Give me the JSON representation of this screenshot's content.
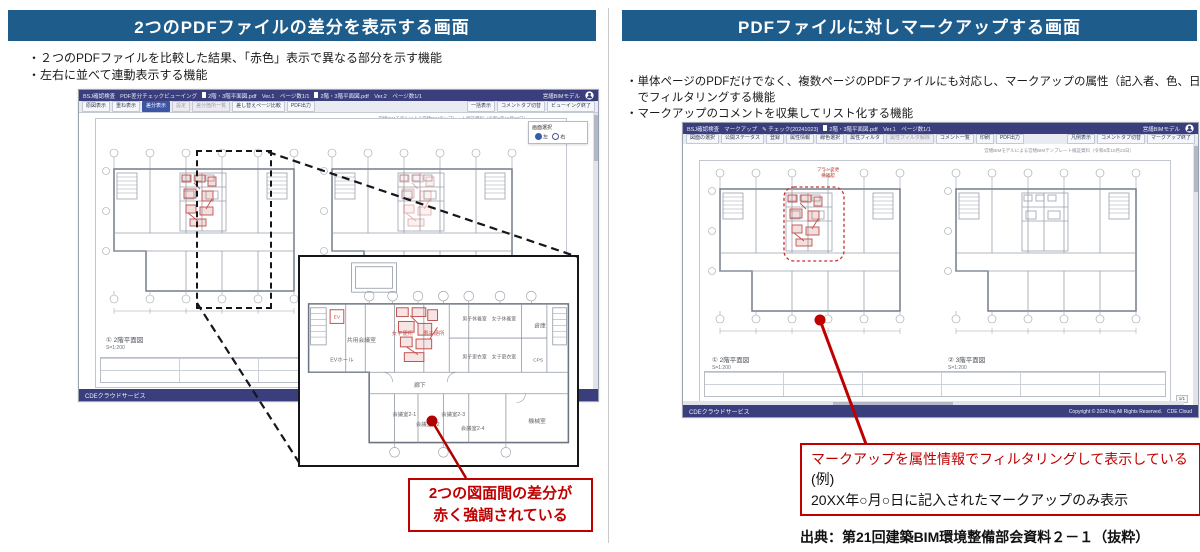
{
  "left_panel": {
    "title": "2つのPDFファイルの差分を表示する画面",
    "bullets": [
      "・２つのPDFファイルを比較した結果、「赤色」表示で異なる部分を示す機能",
      "・左右に並べて連動表示する機能"
    ],
    "app": {
      "brand": "BSJ確認検査",
      "app_name": "PDF差分チェックビューイング",
      "doc1": "2階・3階平面図.pdf　Ver.1　ページ数1/1",
      "doc2": "2階・3階平面図.pdf　Ver.2　ページ数1/1",
      "model": "営繕BIMモデル",
      "toolbar": [
        "原図表示",
        "重ね表示",
        "差分表示",
        "設定",
        "差分箇所一覧",
        "差し替えページ比較",
        "PDF出力"
      ],
      "toolbar_right": [
        "一括表示",
        "コメントタブ切替",
        "ビューイング終了"
      ],
      "note": "営繕BIMモデルによる営繕BIMテンプレート検証資料（令和6年10月23日）",
      "selector": {
        "label": "画面選択",
        "opt_left": "左",
        "opt_right": "右"
      },
      "caption_a": "① 2階平面図",
      "caption_a_scale": "S=1:200",
      "caption_b": "① 2階平面図",
      "caption_b_scale": "S=1:200",
      "footer": "CDEクラウドサービス"
    },
    "callout": [
      "2つの図面間の差分が",
      "赤く強調されている"
    ]
  },
  "right_panel": {
    "title": "PDFファイルに対しマークアップする画面",
    "bullets": [
      "・単体ページのPDFだけでなく、複数ページのPDFファイルにも対応し、マークアップの属性（記入者、色、日付等）",
      "　でフィルタリングする機能",
      "・マークアップのコメントを収集してリスト化する機能"
    ],
    "app": {
      "brand": "BSJ確認検査",
      "app_name": "マークアップ",
      "session": "チェック(20241023)",
      "doc1": "2階・3階平面図.pdf　Ver.1　ページ数1/1",
      "model": "営繕BIMモデル",
      "toolbar": [
        "図面の選択",
        "公開ステータス",
        "登録",
        "属性情報",
        "線色選択",
        "属性フィルタ",
        "属性フィルタ解除",
        "コメント一覧",
        "印刷",
        "PDF出力"
      ],
      "toolbar_right": [
        "凡例表示",
        "コメントタブ切替",
        "マークアップ終了"
      ],
      "note": "営繕BIMモデルによる営繕BIMテンプレート検証資料（令和6年10月23日）",
      "caption_a": "① 2階平面図",
      "caption_a_scale": "S=1:200",
      "caption_b": "② 3階平面図",
      "caption_b_scale": "S=1:200",
      "cloud_note": [
        "プラン変更",
        "要確認"
      ],
      "pager": "1/1",
      "footer_left": "CDEクラウドサービス",
      "footer_right": "Copyright © 2024 bsj All Rights Reserved.　CDE Cloud"
    },
    "callout": {
      "line1": "マークアップを属性情報でフィルタリングして表示している",
      "line2": "(例)",
      "line3": "20XX年○月○日に記入されたマークアップのみ表示"
    },
    "source": "出典：第21回建築BIM環境整備部会資料２－１（抜粋）"
  },
  "inset": {
    "rooms": {
      "ev": "EV",
      "kyoyo": "共用会議室",
      "joshi_benjo": "女子便所",
      "danshi_benjo": "男子便所",
      "danshi_kyuyo": "男子休養室",
      "joshi_kyuyo": "女子休養室",
      "soko": "倉庫",
      "ev_hall": "EVホール",
      "danshi_koi": "男子更衣室",
      "joshi_koi": "女子更衣室",
      "cps": "CPS",
      "roka": "廊下",
      "k21": "会議室2-1",
      "k22": "会議室2-2",
      "k23": "会議室2-3",
      "k24": "会議室2-4",
      "kikai": "機械室"
    }
  },
  "colors": {
    "header_bg": "#1E5C8C",
    "titlebar_bg": "#3B3E7D",
    "accent_red": "#C00000",
    "diff_red": "#C0504D"
  }
}
